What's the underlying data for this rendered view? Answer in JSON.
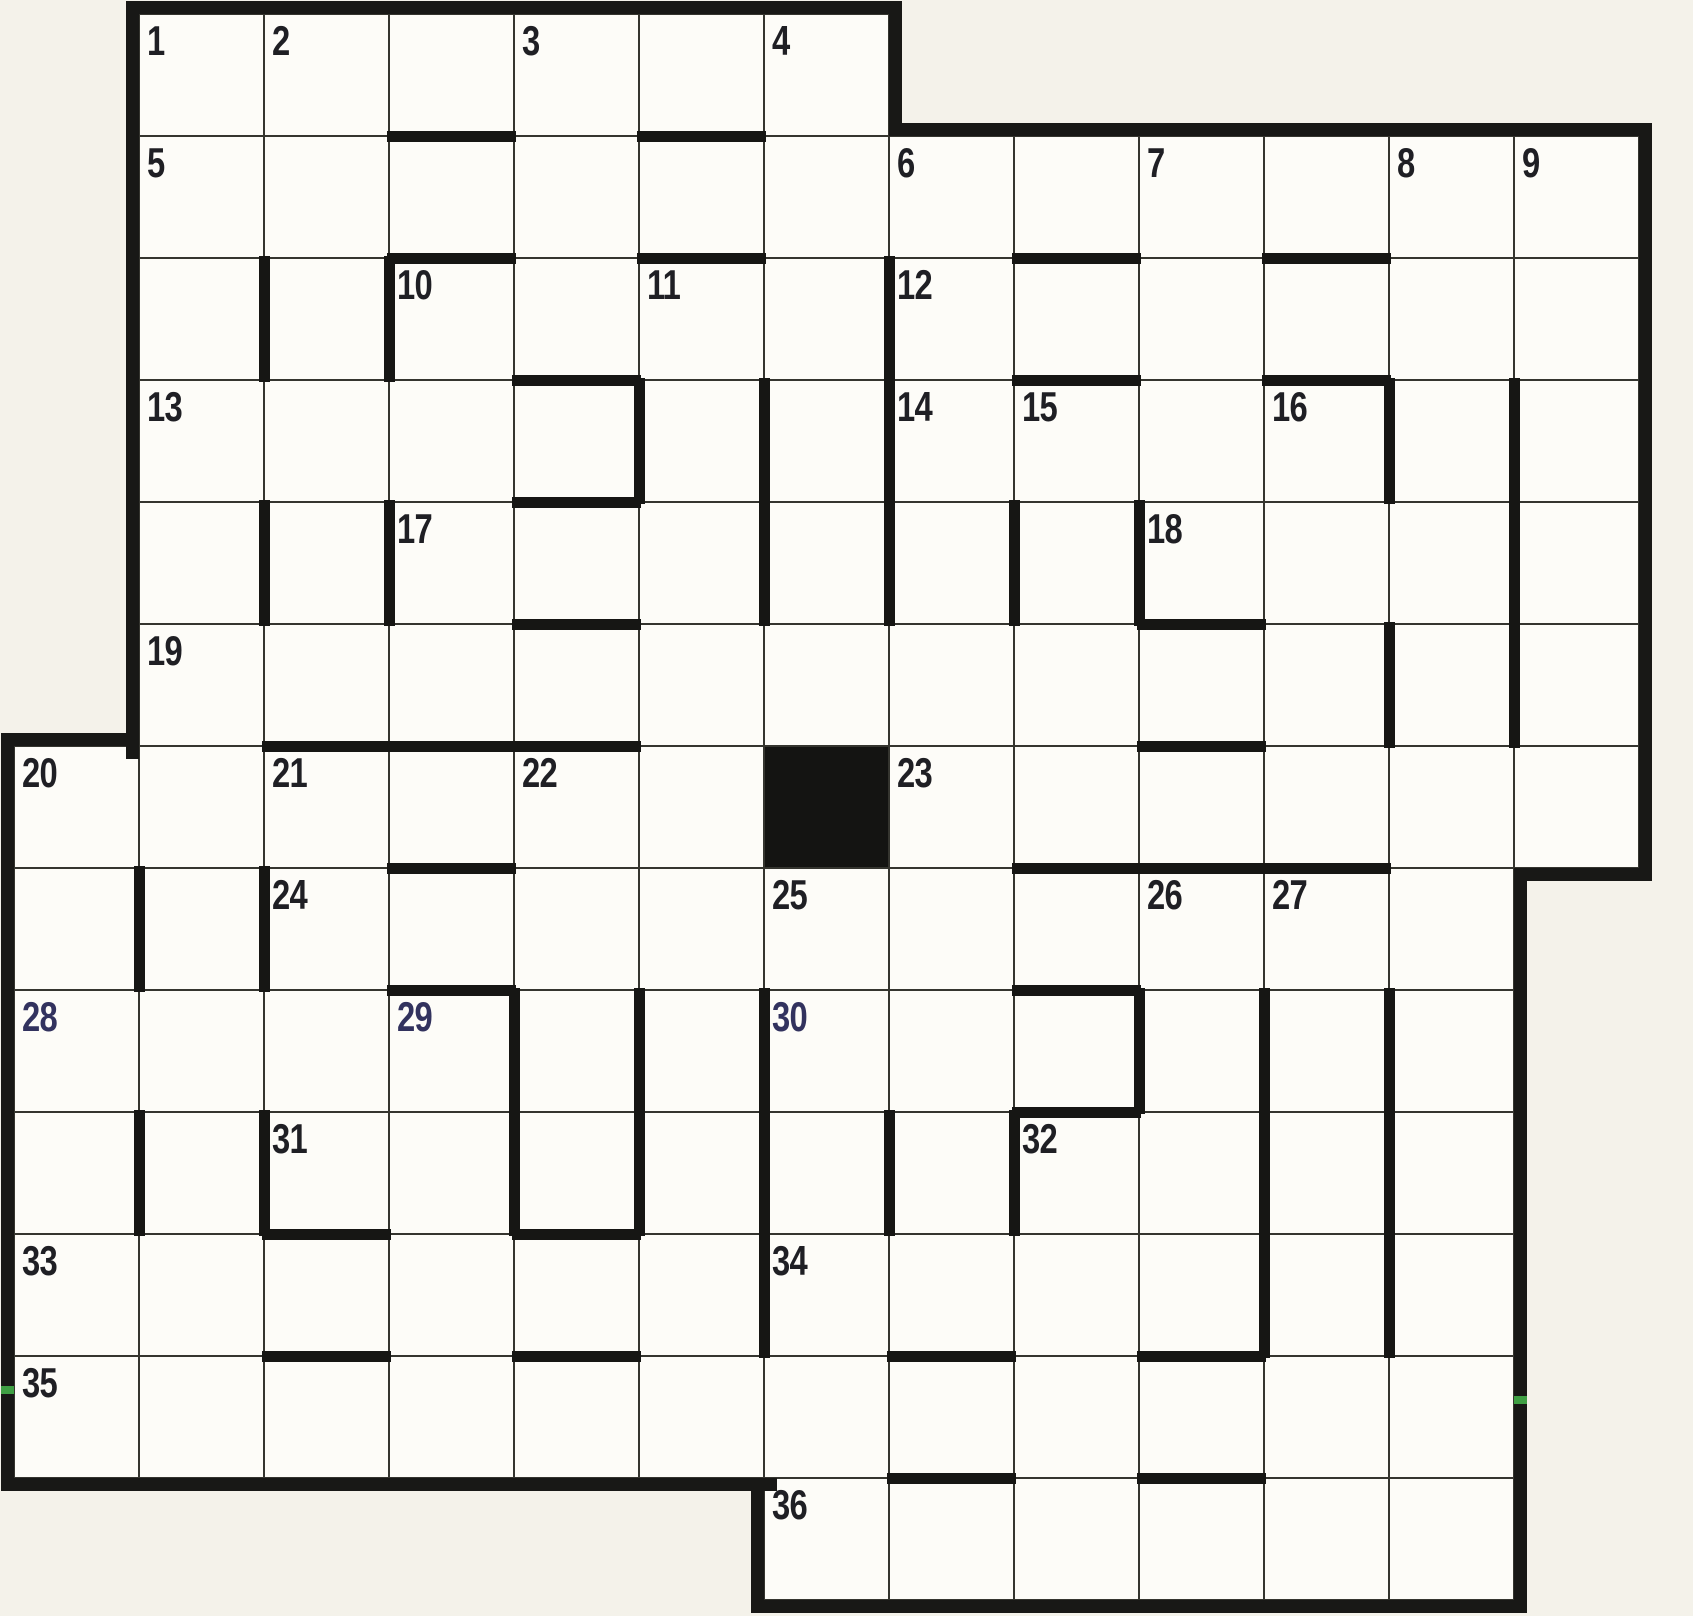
{
  "grid": {
    "origin": [
      14,
      14
    ],
    "cell_w": 125,
    "cell_h": 122,
    "rows": 13,
    "cols": 13,
    "row_spans": [
      [
        0,
        1,
        6
      ],
      [
        1,
        1,
        12
      ],
      [
        2,
        1,
        12
      ],
      [
        3,
        1,
        12
      ],
      [
        4,
        1,
        12
      ],
      [
        5,
        1,
        12
      ],
      [
        6,
        0,
        12
      ],
      [
        7,
        0,
        11
      ],
      [
        8,
        0,
        11
      ],
      [
        9,
        0,
        11
      ],
      [
        10,
        0,
        11
      ],
      [
        11,
        0,
        11
      ],
      [
        12,
        6,
        11
      ]
    ],
    "black_cells": [
      [
        6,
        6
      ]
    ],
    "numbers": {
      "1": [
        0,
        1
      ],
      "2": [
        0,
        2
      ],
      "3": [
        0,
        4
      ],
      "4": [
        0,
        6
      ],
      "5": [
        1,
        1
      ],
      "6": [
        1,
        7
      ],
      "7": [
        1,
        9
      ],
      "8": [
        1,
        11
      ],
      "9": [
        1,
        12
      ],
      "10": [
        2,
        3
      ],
      "11": [
        2,
        5
      ],
      "12": [
        2,
        7
      ],
      "13": [
        3,
        1
      ],
      "14": [
        3,
        7
      ],
      "15": [
        3,
        8
      ],
      "16": [
        3,
        10
      ],
      "17": [
        4,
        3
      ],
      "18": [
        4,
        9
      ],
      "19": [
        5,
        1
      ],
      "20": [
        6,
        0
      ],
      "21": [
        6,
        2
      ],
      "22": [
        6,
        4
      ],
      "23": [
        6,
        7
      ],
      "24": [
        7,
        2
      ],
      "25": [
        7,
        6
      ],
      "26": [
        7,
        9
      ],
      "27": [
        7,
        10
      ],
      "28": [
        8,
        0
      ],
      "29": [
        8,
        3
      ],
      "30": [
        8,
        6
      ],
      "31": [
        9,
        2
      ],
      "32": [
        9,
        8
      ],
      "33": [
        10,
        0
      ],
      "34": [
        10,
        6
      ],
      "35": [
        11,
        0
      ],
      "36": [
        12,
        6
      ]
    },
    "blue_ink_numbers": [
      28,
      29,
      30
    ],
    "bars_top": [
      [
        1,
        3
      ],
      [
        1,
        5
      ],
      [
        2,
        3
      ],
      [
        2,
        5
      ],
      [
        2,
        8
      ],
      [
        2,
        10
      ],
      [
        3,
        4
      ],
      [
        3,
        8
      ],
      [
        3,
        10
      ],
      [
        4,
        4
      ],
      [
        5,
        4
      ],
      [
        5,
        9
      ],
      [
        6,
        2
      ],
      [
        6,
        3
      ],
      [
        6,
        4
      ],
      [
        6,
        9
      ],
      [
        7,
        3
      ],
      [
        7,
        8
      ],
      [
        7,
        9
      ],
      [
        7,
        10
      ],
      [
        8,
        3
      ],
      [
        8,
        8
      ],
      [
        9,
        8
      ],
      [
        10,
        2
      ],
      [
        10,
        4
      ],
      [
        11,
        2
      ],
      [
        11,
        4
      ],
      [
        11,
        7
      ],
      [
        11,
        9
      ],
      [
        12,
        7
      ],
      [
        12,
        9
      ]
    ],
    "bars_left": [
      [
        2,
        2
      ],
      [
        2,
        3
      ],
      [
        2,
        7
      ],
      [
        3,
        5
      ],
      [
        3,
        6
      ],
      [
        3,
        7
      ],
      [
        3,
        11
      ],
      [
        3,
        12
      ],
      [
        4,
        2
      ],
      [
        4,
        3
      ],
      [
        4,
        6
      ],
      [
        4,
        7
      ],
      [
        4,
        8
      ],
      [
        4,
        9
      ],
      [
        4,
        12
      ],
      [
        5,
        11
      ],
      [
        5,
        12
      ],
      [
        7,
        1
      ],
      [
        7,
        2
      ],
      [
        8,
        4
      ],
      [
        8,
        5
      ],
      [
        8,
        6
      ],
      [
        8,
        9
      ],
      [
        8,
        10
      ],
      [
        8,
        11
      ],
      [
        9,
        1
      ],
      [
        9,
        2
      ],
      [
        9,
        4
      ],
      [
        9,
        5
      ],
      [
        9,
        6
      ],
      [
        9,
        7
      ],
      [
        9,
        8
      ],
      [
        9,
        10
      ],
      [
        9,
        11
      ],
      [
        10,
        6
      ],
      [
        10,
        10
      ],
      [
        10,
        11
      ]
    ],
    "border_segments": [
      [
        126,
        1,
        776,
        13
      ],
      [
        889,
        1,
        13,
        135
      ],
      [
        889,
        123,
        763,
        13
      ],
      [
        1639,
        123,
        13,
        758
      ],
      [
        1514,
        868,
        138,
        13
      ],
      [
        1514,
        868,
        13,
        745
      ],
      [
        751,
        1600,
        776,
        13
      ],
      [
        751,
        1478,
        13,
        135
      ],
      [
        1,
        1478,
        776,
        13
      ],
      [
        1,
        733,
        13,
        758
      ],
      [
        1,
        733,
        138,
        13
      ],
      [
        126,
        1,
        13,
        758
      ]
    ],
    "scan_artifacts_green": [
      [
        1,
        1386,
        13,
        8
      ],
      [
        1514,
        1396,
        13,
        8
      ]
    ],
    "colors": {
      "page_background": "#f4f2ea",
      "cell_background": "#fdfcf8",
      "line_color": "#35352f",
      "bar_color": "#161614",
      "number_color": "#1f1f24",
      "blue_ink_color": "#32325e",
      "artifact_green": "#3fa044"
    }
  }
}
